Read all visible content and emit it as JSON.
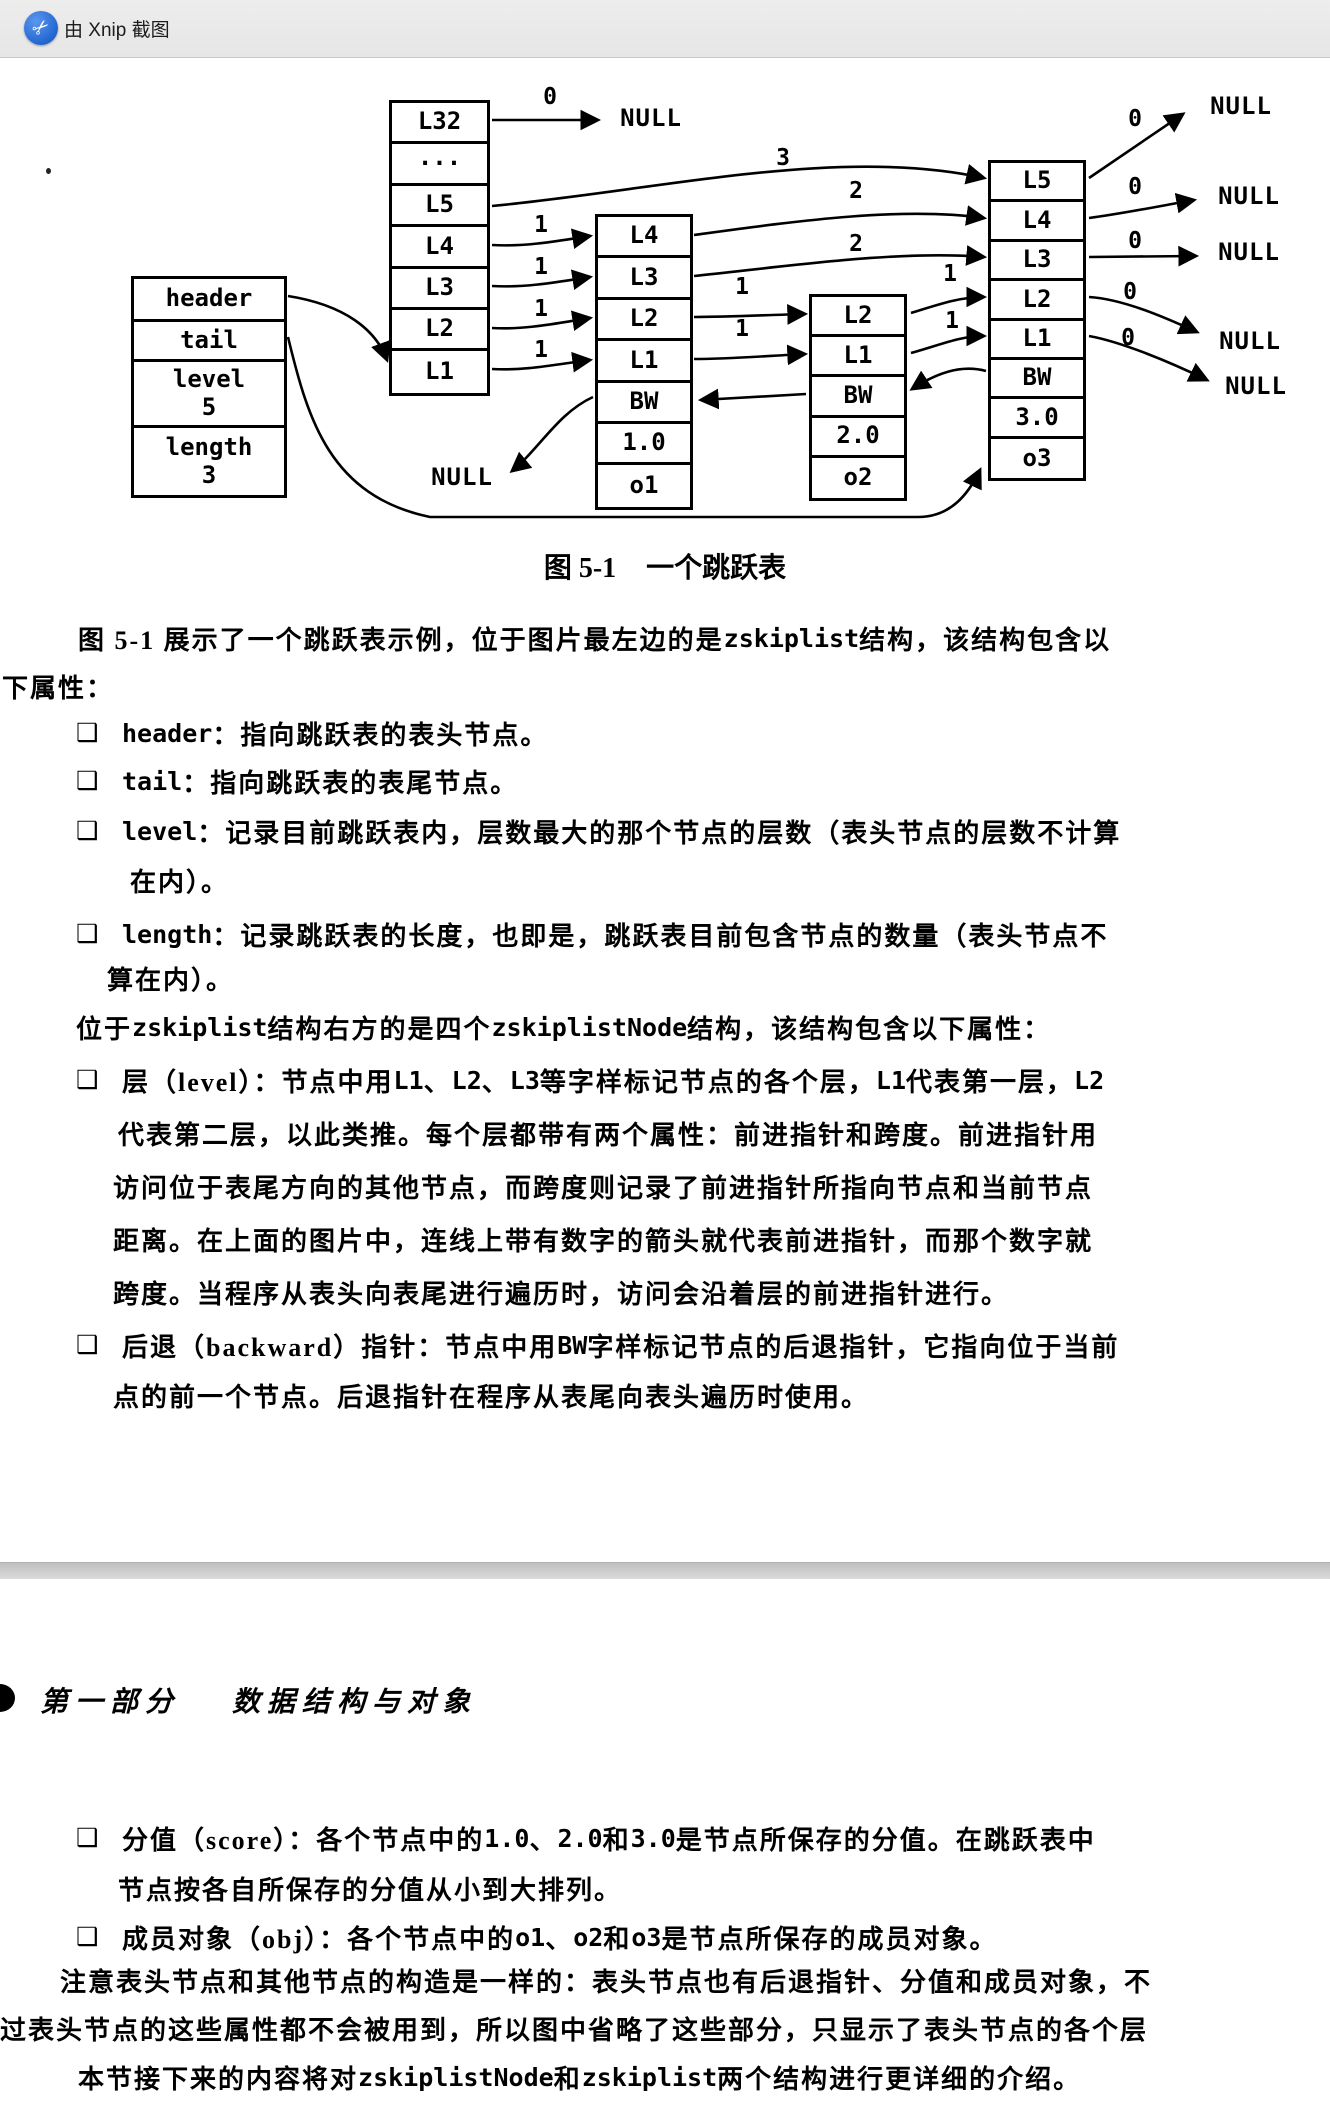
{
  "titlebar": {
    "app_label": "由 Xnip 截图"
  },
  "colors": {
    "accent_blue": "#2266d0",
    "bar_gray": "#eaeaea",
    "band_gray": "#cccccc",
    "ink": "#000000"
  },
  "figure": {
    "caption_no": "图 5-1",
    "caption_title": "一个跳跃表",
    "null_label": "NULL",
    "structs": [
      {
        "name": "zskiplist",
        "x": 131,
        "y": 276,
        "w": 156,
        "row_h": 42,
        "rows": [
          {
            "t": "header",
            "h": 43
          },
          {
            "t": "tail",
            "h": 40
          },
          {
            "t": "level\n5",
            "h": 66
          },
          {
            "t": "length\n3",
            "h": 67
          }
        ]
      },
      {
        "name": "header-node",
        "x": 389,
        "y": 100,
        "w": 101,
        "row_h": 41.4,
        "rows": [
          {
            "t": "L32"
          },
          {
            "t": "···"
          },
          {
            "t": "L5"
          },
          {
            "t": "L4"
          },
          {
            "t": "L3"
          },
          {
            "t": "L2"
          },
          {
            "t": "L1"
          }
        ]
      },
      {
        "name": "node-1",
        "x": 595,
        "y": 214,
        "w": 98,
        "row_h": 41.4,
        "rows": [
          {
            "t": "L4"
          },
          {
            "t": "L3"
          },
          {
            "t": "L2"
          },
          {
            "t": "L1"
          },
          {
            "t": "BW"
          },
          {
            "t": "1.0"
          },
          {
            "t": "o1"
          }
        ]
      },
      {
        "name": "node-2",
        "x": 809,
        "y": 294,
        "w": 98,
        "row_h": 40.2,
        "rows": [
          {
            "t": "L2"
          },
          {
            "t": "L1"
          },
          {
            "t": "BW"
          },
          {
            "t": "2.0"
          },
          {
            "t": "o2"
          }
        ]
      },
      {
        "name": "node-3",
        "x": 988,
        "y": 160,
        "w": 98,
        "row_h": 39.4,
        "rows": [
          {
            "t": "L5"
          },
          {
            "t": "L4"
          },
          {
            "t": "L3"
          },
          {
            "t": "L2"
          },
          {
            "t": "L1"
          },
          {
            "t": "BW"
          },
          {
            "t": "3.0"
          },
          {
            "t": "o3"
          }
        ]
      }
    ],
    "span_labels": [
      {
        "t": "0",
        "x": 550,
        "y": 97
      },
      {
        "t": "0",
        "x": 1135,
        "y": 119
      },
      {
        "t": "0",
        "x": 1135,
        "y": 187
      },
      {
        "t": "0",
        "x": 1135,
        "y": 241
      },
      {
        "t": "0",
        "x": 1130,
        "y": 292
      },
      {
        "t": "0",
        "x": 1128,
        "y": 338
      },
      {
        "t": "3",
        "x": 783,
        "y": 158
      },
      {
        "t": "2",
        "x": 856,
        "y": 191
      },
      {
        "t": "2",
        "x": 856,
        "y": 244
      },
      {
        "t": "1",
        "x": 541,
        "y": 225
      },
      {
        "t": "1",
        "x": 541,
        "y": 267
      },
      {
        "t": "1",
        "x": 541,
        "y": 309
      },
      {
        "t": "1",
        "x": 541,
        "y": 350
      },
      {
        "t": "1",
        "x": 742,
        "y": 287
      },
      {
        "t": "1",
        "x": 742,
        "y": 329
      },
      {
        "t": "1",
        "x": 950,
        "y": 274
      },
      {
        "t": "1",
        "x": 952,
        "y": 321
      }
    ],
    "null_labels": [
      {
        "x": 651,
        "y": 118
      },
      {
        "x": 1241,
        "y": 106
      },
      {
        "x": 1249,
        "y": 196
      },
      {
        "x": 1249,
        "y": 252
      },
      {
        "x": 1250,
        "y": 341
      },
      {
        "x": 1256,
        "y": 386
      },
      {
        "x": 462,
        "y": 477
      }
    ]
  },
  "body": {
    "bullet_char": "❑",
    "lines": [
      {
        "x": 78,
        "y": 612,
        "segs": [
          {
            "t": "图 5-1 展示了一个跳跃表示例，位于图片最左边的是 "
          },
          {
            "t": "zskiplist",
            "c": 1
          },
          {
            "t": " 结构，该结构包含以"
          }
        ]
      },
      {
        "x": 2,
        "y": 660,
        "segs": [
          {
            "t": "下属性："
          }
        ]
      },
      {
        "x": 76,
        "y": 707,
        "b": 1,
        "segs": [
          {
            "t": "header",
            "c": 1
          },
          {
            "t": "：指向跳跃表的表头节点。"
          }
        ]
      },
      {
        "x": 76,
        "y": 755,
        "b": 1,
        "segs": [
          {
            "t": "tail",
            "c": 1
          },
          {
            "t": "：指向跳跃表的表尾节点。"
          }
        ]
      },
      {
        "x": 76,
        "y": 805,
        "b": 1,
        "segs": [
          {
            "t": "level",
            "c": 1
          },
          {
            "t": "：记录目前跳跃表内，层数最大的那个节点的层数（表头节点的层数不计算"
          }
        ]
      },
      {
        "x": 130,
        "y": 854,
        "segs": [
          {
            "t": "在内）。"
          }
        ]
      },
      {
        "x": 76,
        "y": 908,
        "b": 1,
        "segs": [
          {
            "t": "length",
            "c": 1
          },
          {
            "t": "：记录跳跃表的长度，也即是，跳跃表目前包含节点的数量（表头节点不"
          }
        ]
      },
      {
        "x": 107,
        "y": 952,
        "segs": [
          {
            "t": "算在内）。"
          }
        ]
      },
      {
        "x": 76,
        "y": 1001,
        "segs": [
          {
            "t": "位于 "
          },
          {
            "t": "zskiplist",
            "c": 1
          },
          {
            "t": " 结构右方的是四个 "
          },
          {
            "t": "zskiplistNode",
            "c": 1
          },
          {
            "t": " 结构，该结构包含以下属性："
          }
        ]
      },
      {
        "x": 76,
        "y": 1054,
        "b": 1,
        "segs": [
          {
            "t": "层（level）：节点中用 "
          },
          {
            "t": "L1",
            "c": 1
          },
          {
            "t": "、"
          },
          {
            "t": "L2",
            "c": 1
          },
          {
            "t": "、"
          },
          {
            "t": "L3",
            "c": 1
          },
          {
            "t": " 等字样标记节点的各个层，"
          },
          {
            "t": "L1",
            "c": 1
          },
          {
            "t": " 代表第一层，"
          },
          {
            "t": "L2",
            "c": 1
          }
        ]
      },
      {
        "x": 118,
        "y": 1107,
        "segs": [
          {
            "t": "代表第二层，以此类推。每个层都带有两个属性：前进指针和跨度。前进指针用"
          }
        ]
      },
      {
        "x": 113,
        "y": 1160,
        "segs": [
          {
            "t": "访问位于表尾方向的其他节点，而跨度则记录了前进指针所指向节点和当前节点"
          }
        ]
      },
      {
        "x": 113,
        "y": 1213,
        "segs": [
          {
            "t": "距离。在上面的图片中，连线上带有数字的箭头就代表前进指针，而那个数字就"
          }
        ]
      },
      {
        "x": 113,
        "y": 1266,
        "segs": [
          {
            "t": "跨度。当程序从表头向表尾进行遍历时，访问会沿着层的前进指针进行。"
          }
        ]
      },
      {
        "x": 76,
        "y": 1319,
        "b": 1,
        "segs": [
          {
            "t": "后退（backward）指针：节点中用 "
          },
          {
            "t": "BW",
            "c": 1
          },
          {
            "t": " 字样标记节点的后退指针，它指向位于当前"
          }
        ]
      },
      {
        "x": 113,
        "y": 1369,
        "segs": [
          {
            "t": "点的前一个节点。后退指针在程序从表尾向表头遍历时使用。"
          }
        ]
      },
      {
        "x": 76,
        "y": 1812,
        "b": 1,
        "segs": [
          {
            "t": "分值（score）：各个节点中的 "
          },
          {
            "t": "1.0",
            "c": 1
          },
          {
            "t": "、"
          },
          {
            "t": "2.0",
            "c": 1
          },
          {
            "t": " 和 "
          },
          {
            "t": "3.0",
            "c": 1
          },
          {
            "t": " 是节点所保存的分值。在跳跃表中"
          }
        ]
      },
      {
        "x": 118,
        "y": 1862,
        "segs": [
          {
            "t": "节点按各自所保存的分值从小到大排列。"
          }
        ]
      },
      {
        "x": 76,
        "y": 1911,
        "b": 1,
        "segs": [
          {
            "t": "成员对象（obj）：各个节点中的 "
          },
          {
            "t": "o1",
            "c": 1
          },
          {
            "t": "、"
          },
          {
            "t": "o2",
            "c": 1
          },
          {
            "t": " 和 "
          },
          {
            "t": "o3",
            "c": 1
          },
          {
            "t": " 是节点所保存的成员对象。"
          }
        ]
      },
      {
        "x": 60,
        "y": 1954,
        "segs": [
          {
            "t": "注意表头节点和其他节点的构造是一样的：表头节点也有后退指针、分值和成员对象，不"
          }
        ]
      },
      {
        "x": 0,
        "y": 2002,
        "segs": [
          {
            "t": "过表头节点的这些属性都不会被用到，所以图中省略了这些部分，只显示了表头节点的各个层"
          }
        ]
      },
      {
        "x": 78,
        "y": 2051,
        "segs": [
          {
            "t": "本节接下来的内容将对 "
          },
          {
            "t": "zskiplistNode",
            "c": 1
          },
          {
            "t": " 和 "
          },
          {
            "t": "zskiplist",
            "c": 1
          },
          {
            "t": " 两个结构进行更详细的介绍。"
          }
        ]
      }
    ]
  },
  "part_header": {
    "part_no": "第一部分",
    "part_title": "数据结构与对象"
  }
}
